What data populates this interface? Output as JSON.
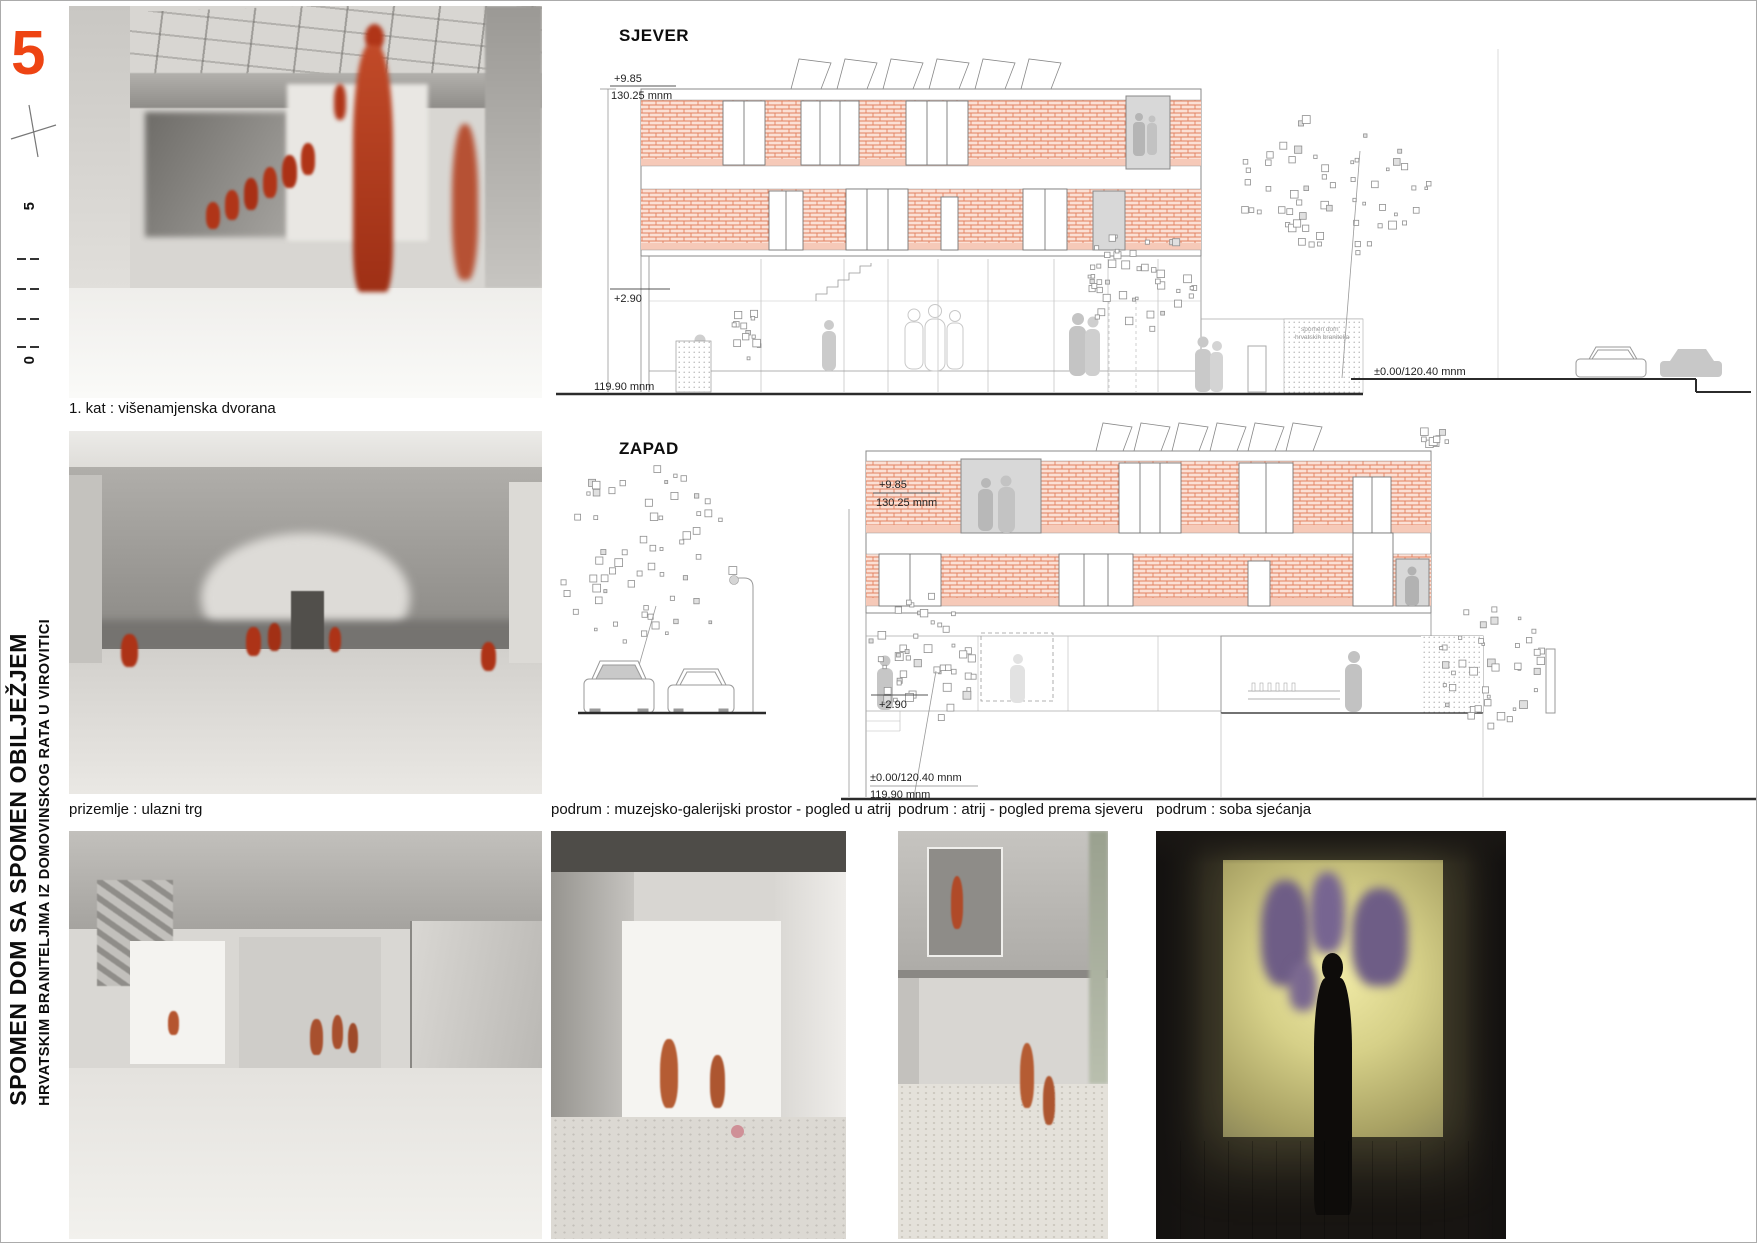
{
  "panel": {
    "number": "5",
    "scale_top": "5",
    "scale_bottom": "0"
  },
  "side_title": {
    "line1": "SPOMEN DOM SA SPOMEN OBILJEŽJEM",
    "line2": "HRVATSKIM BRANITELJIMA IZ DOMOVINSKOG RATA U VIROVITICI"
  },
  "photos": [
    {
      "caption": "1. kat : višenamjenska dvorana"
    },
    {
      "caption": "prizemlje : ulazni trg"
    },
    {
      "caption": ""
    },
    {
      "caption": "podrum : muzejsko-galerijski prostor - pogled u atrij"
    },
    {
      "caption": "podrum : atrij - pogled prema sjeveru"
    },
    {
      "caption": "podrum : soba sjećanja"
    }
  ],
  "elevation_north": {
    "title": "SJEVER",
    "level_top": "+9.85",
    "datum_top": "130.25 mnm",
    "level_mid": "+2.90",
    "datum_ground": "119.90 mnm",
    "level_zero": "±0.00/120.40 mnm",
    "building_label_1": "spomen dom",
    "building_label_2": "hrvatskih branitelja"
  },
  "elevation_west": {
    "title": "ZAPAD",
    "level_top": "+9.85",
    "datum_top": "130.25 mnm",
    "level_mid": "+2.90",
    "level_zero": "±0.00/120.40 mnm",
    "datum_ground": "119.90 mnm"
  },
  "colors": {
    "accent_orange": "#ee4413",
    "brick_line": "#e2815f",
    "brick_fill": "#fbe0d5",
    "figure_red": "#b03518"
  }
}
